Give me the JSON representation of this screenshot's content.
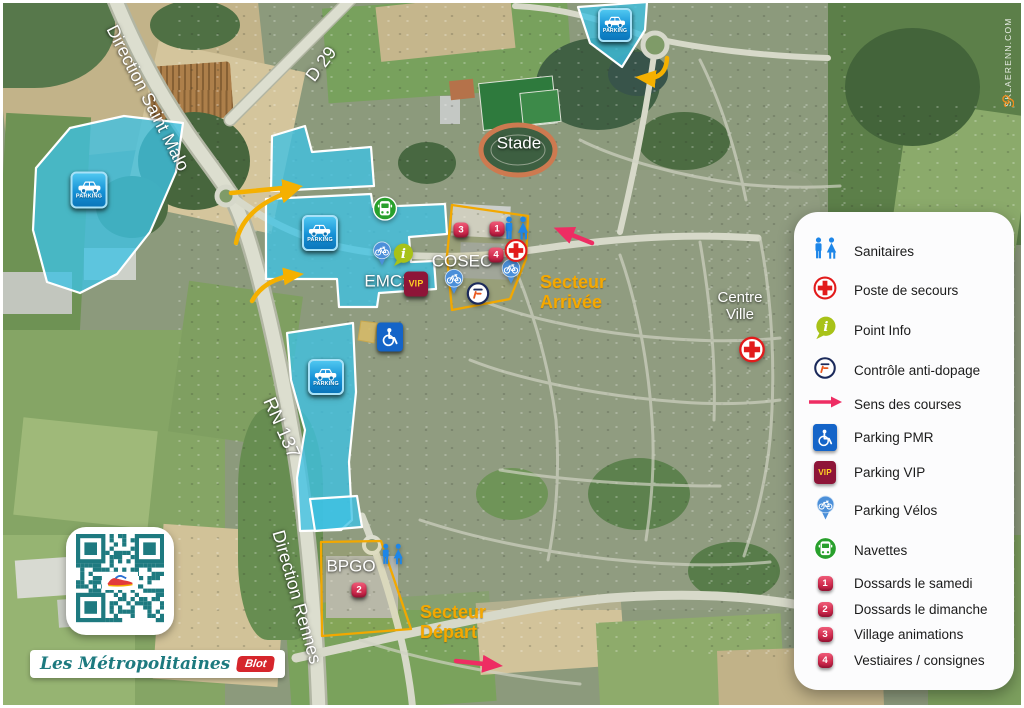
{
  "map": {
    "parking_label": "PARKING",
    "vip_label": "VIP",
    "watermark": "SKLAERENN.COM",
    "labels": [
      {
        "id": "direction-saint-malo",
        "lines": [
          "Direction Saint Malo"
        ],
        "x": 148,
        "y": 98,
        "rotate": 63,
        "size": 18
      },
      {
        "id": "d29",
        "lines": [
          "D 29"
        ],
        "x": 321,
        "y": 64,
        "rotate": -53,
        "size": 18
      },
      {
        "id": "stade",
        "lines": [
          "Stade"
        ],
        "x": 519,
        "y": 143,
        "rotate": 0,
        "size": 17
      },
      {
        "id": "cosec",
        "lines": [
          "COSEC"
        ],
        "x": 462,
        "y": 261,
        "rotate": 0,
        "size": 17
      },
      {
        "id": "emc2",
        "lines": [
          "EMC2"
        ],
        "x": 388,
        "y": 281,
        "rotate": 0,
        "size": 17
      },
      {
        "id": "centre-ville",
        "lines": [
          "Centre",
          "Ville"
        ],
        "x": 740,
        "y": 307,
        "rotate": 0,
        "size": 15
      },
      {
        "id": "rn137",
        "lines": [
          "RN 137"
        ],
        "x": 281,
        "y": 428,
        "rotate": 66,
        "size": 19
      },
      {
        "id": "direction-rennes",
        "lines": [
          "Direction Rennes"
        ],
        "x": 297,
        "y": 597,
        "rotate": 74,
        "size": 18
      },
      {
        "id": "bpgo",
        "lines": [
          "BPGO"
        ],
        "x": 351,
        "y": 566,
        "rotate": 0,
        "size": 17
      },
      {
        "id": "secteur-arrivee",
        "lines": [
          "Secteur",
          "Arrivée"
        ],
        "x": 573,
        "y": 292,
        "rotate": 0,
        "size": 18,
        "color": "#f5a800",
        "bold": true,
        "align": "left"
      },
      {
        "id": "secteur-depart",
        "lines": [
          "Secteur",
          "Départ"
        ],
        "x": 453,
        "y": 622,
        "rotate": 0,
        "size": 18,
        "color": "#f5a800",
        "bold": true,
        "align": "left"
      }
    ],
    "markers": [
      {
        "type": "parking",
        "x": 89,
        "y": 190,
        "s": 37
      },
      {
        "type": "parking",
        "x": 320,
        "y": 233,
        "s": 36
      },
      {
        "type": "parking",
        "x": 326,
        "y": 377,
        "s": 36
      },
      {
        "type": "parking",
        "x": 615,
        "y": 25,
        "s": 34
      },
      {
        "type": "navette",
        "x": 385,
        "y": 211,
        "s": 26
      },
      {
        "type": "velo",
        "x": 382,
        "y": 256,
        "s": 21
      },
      {
        "type": "velo",
        "x": 454,
        "y": 284,
        "s": 22
      },
      {
        "type": "velo",
        "x": 511,
        "y": 274,
        "s": 22
      },
      {
        "type": "info",
        "x": 403,
        "y": 257,
        "s": 25
      },
      {
        "type": "vip",
        "x": 416,
        "y": 284,
        "s": 24
      },
      {
        "type": "pmr",
        "x": 390,
        "y": 337,
        "s": 26
      },
      {
        "type": "sanitaires",
        "x": 516,
        "y": 231,
        "s": 28
      },
      {
        "type": "sanitaires",
        "x": 392,
        "y": 557,
        "s": 25
      },
      {
        "type": "redcross",
        "x": 516,
        "y": 253,
        "s": 24
      },
      {
        "type": "redcross",
        "x": 752,
        "y": 352,
        "s": 27
      },
      {
        "type": "dopage",
        "x": 478,
        "y": 296,
        "s": 25
      },
      {
        "type": "num",
        "n": "1",
        "x": 497,
        "y": 229,
        "s": 15
      },
      {
        "type": "num",
        "n": "2",
        "x": 359,
        "y": 590,
        "s": 15
      },
      {
        "type": "num",
        "n": "3",
        "x": 461,
        "y": 230,
        "s": 15
      },
      {
        "type": "num",
        "n": "4",
        "x": 496,
        "y": 255,
        "s": 15
      }
    ]
  },
  "legend": {
    "items": [
      {
        "icon": "sanitaires",
        "label": "Sanitaires"
      },
      {
        "icon": "redcross",
        "label": "Poste de secours"
      },
      {
        "icon": "info",
        "label": "Point Info"
      },
      {
        "icon": "dopage",
        "label": "Contrôle anti-dopage"
      },
      {
        "icon": "arrow",
        "label": "Sens des courses"
      },
      {
        "icon": "pmr",
        "label": "Parking PMR"
      },
      {
        "icon": "vip",
        "label": "Parking VIP"
      },
      {
        "icon": "velo",
        "label": "Parking Vélos"
      },
      {
        "icon": "navette",
        "label": "Navettes"
      },
      {
        "icon": "num",
        "n": "1",
        "label": "Dossards le samedi"
      },
      {
        "icon": "num",
        "n": "2",
        "label": "Dossards le dimanche"
      },
      {
        "icon": "num",
        "n": "3",
        "label": "Village animations"
      },
      {
        "icon": "num",
        "n": "4",
        "label": "Vestiaires / consignes"
      }
    ]
  },
  "footer": {
    "logo_name": "Les Métropolitaines",
    "logo_badge": "Blot"
  }
}
